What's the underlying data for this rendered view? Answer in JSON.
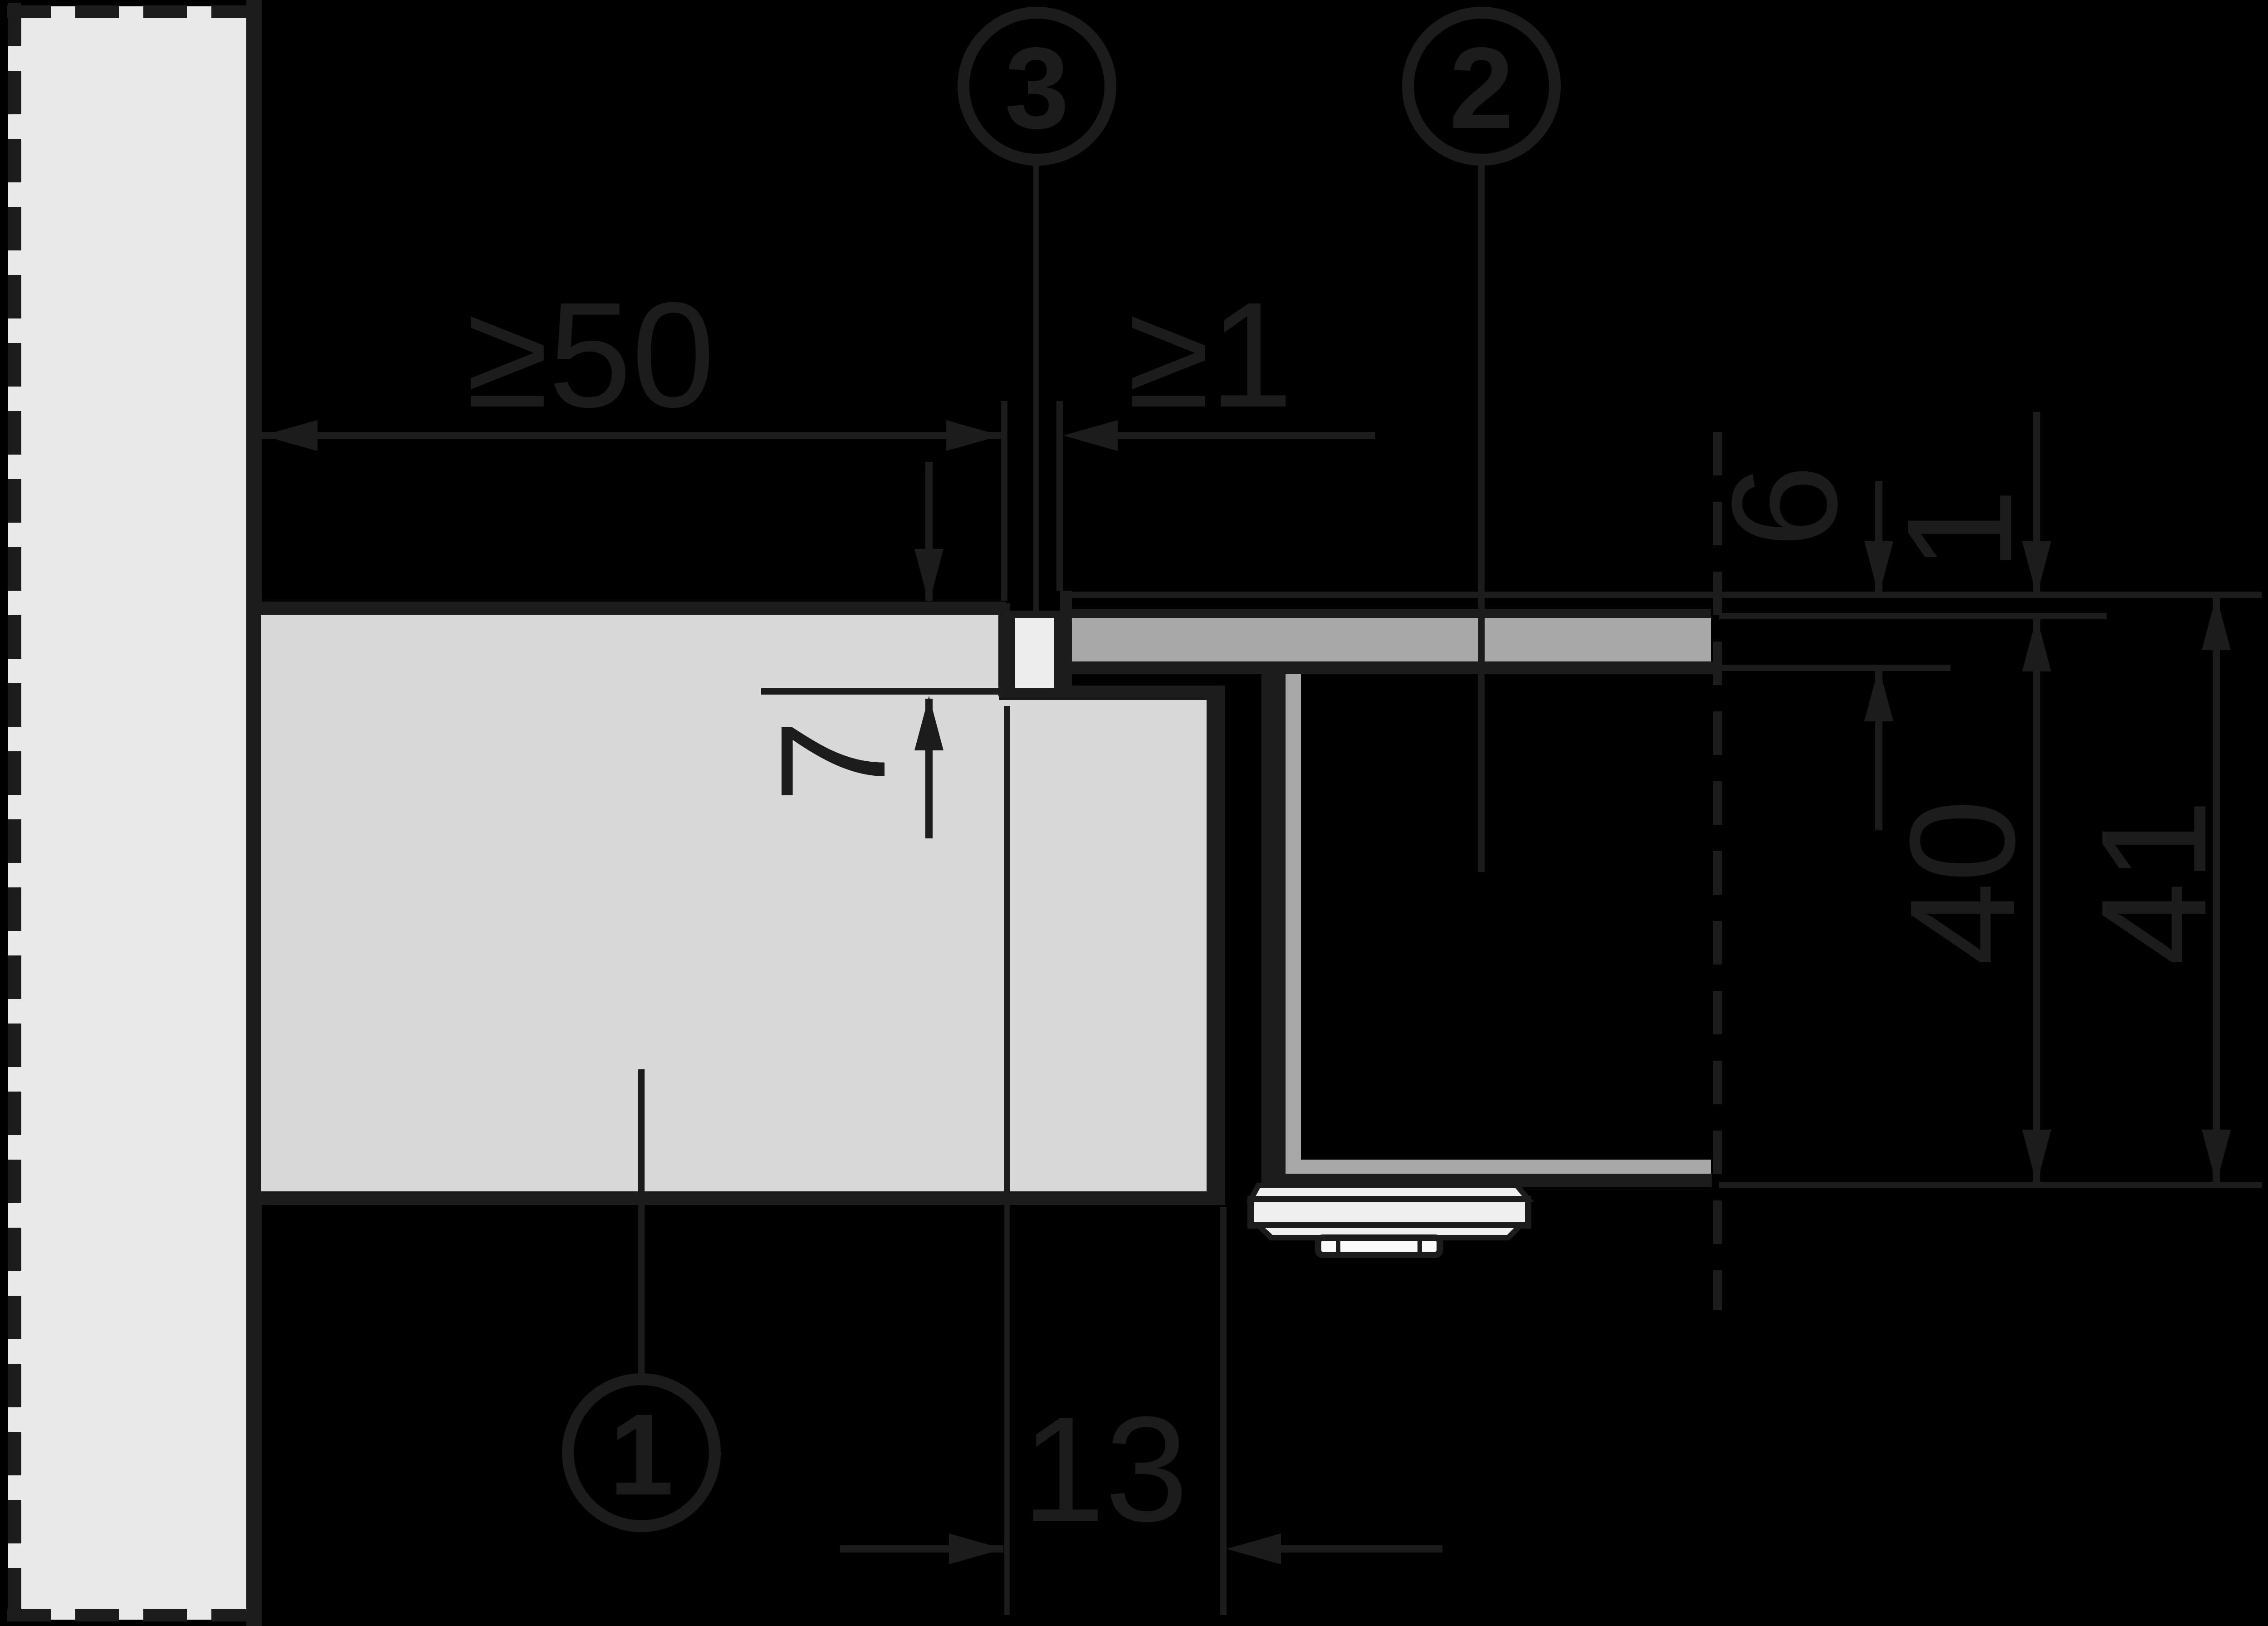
{
  "callouts": {
    "worktop": "1",
    "cooktop": "2",
    "seal": "3"
  },
  "dimensions": {
    "left_clearance": "≥50",
    "front_gap": "≥1",
    "recess_depth": "7",
    "glass_thickness": "6",
    "glass_protrusion": "1",
    "depth_to_worktop": "40",
    "depth_total": "41",
    "ledge_width": "13"
  },
  "colors": {
    "background": "#000000",
    "ink": "#1c1c1c",
    "wall_fill": "#e9e9e9",
    "worktop_fill": "#d8d8d8",
    "cooktop_fill": "#a8a8a8",
    "seal_fill": "#ededed",
    "clamp_fill": "#efefef"
  }
}
